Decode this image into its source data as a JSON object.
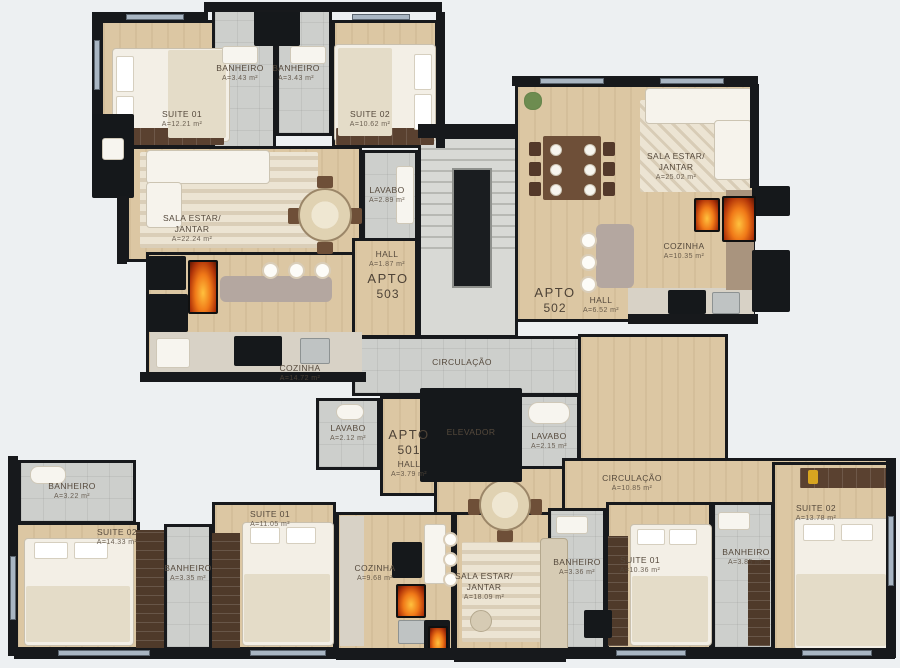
{
  "palette": {
    "background": "#edf0f2",
    "wall": "#17191c",
    "wood": "#dcc7a3",
    "wood_light": "#e6d7b9",
    "tile": "#cdcfcc",
    "rug": "#ece4d3",
    "counter": "#b4a7a0",
    "furn": "#5a4130",
    "fire": "#e2580f",
    "window": "#a9b6c3",
    "label": "#55493c"
  },
  "apartments": {
    "apto503": {
      "id_label": "APTO",
      "id_number": "503",
      "suite01": {
        "name": "SUITE 01",
        "area": "A=12.21 m²"
      },
      "banheiro1": {
        "name": "BANHEIRO",
        "area": "A=3.43 m²"
      },
      "banheiro2": {
        "name": "BANHEIRO",
        "area": "A=3.43 m²"
      },
      "suite02": {
        "name": "SUITE 02",
        "area": "A=10.62 m²"
      },
      "sala": {
        "name1": "SALA ESTAR/",
        "name2": "JANTAR",
        "area": "A=22.24 m²"
      },
      "lavabo": {
        "name": "LAVABO",
        "area": "A=2.89 m²"
      },
      "cozinha": {
        "name": "COZINHA",
        "area": "A=14.72 m²"
      },
      "hall": {
        "name": "HALL",
        "area": "A=1.87 m²"
      }
    },
    "apto502": {
      "id_label": "APTO",
      "id_number": "502",
      "sala": {
        "name1": "SALA ESTAR/",
        "name2": "JANTAR",
        "area": "A=25.02 m²"
      },
      "cozinha": {
        "name": "COZINHA",
        "area": "A=10.35 m²"
      },
      "hall": {
        "name": "HALL",
        "area": "A=6.52 m²"
      }
    },
    "apto501": {
      "id_label": "APTO",
      "id_number": "501",
      "lavabo": {
        "name": "LAVABO",
        "area": "A=2.12 m²"
      },
      "hall": {
        "name": "HALL",
        "area": "A=3.79 m²"
      },
      "banheiro1": {
        "name": "BANHEIRO",
        "area": "A=3.22 m²"
      },
      "suite02": {
        "name": "SUITE 02",
        "area": "A=14.33 m²"
      },
      "banheiro2": {
        "name": "BANHEIRO",
        "area": "A=3.35 m²"
      },
      "suite01": {
        "name": "SUITE 01",
        "area": "A=11.05 m²"
      },
      "cozinha": {
        "name": "COZINHA",
        "area": "A=9.68 m²"
      },
      "sala": {
        "name1": "SALA ESTAR/",
        "name2": "JANTAR",
        "area": "A=18.09 m²"
      }
    },
    "apto_direita": {
      "circulacao": {
        "name": "CIRCULAÇÃO",
        "area": "A=10.85 m²"
      },
      "banheiro1": {
        "name": "BANHEIRO",
        "area": "A=3.36 m²"
      },
      "suite01": {
        "name": "SUITE 01",
        "area": "A=10.36 m²"
      },
      "banheiro2": {
        "name": "BANHEIRO",
        "area": "A=3.85 m²"
      },
      "suite02": {
        "name": "SUITE 02",
        "area": "A=13.78 m²"
      }
    }
  },
  "common": {
    "circulacao": {
      "name": "CIRCULAÇÃO"
    },
    "elevador": {
      "name": "ELEVADOR"
    },
    "lavabo": {
      "name": "LAVABO",
      "area": "A=2.15 m²"
    }
  }
}
